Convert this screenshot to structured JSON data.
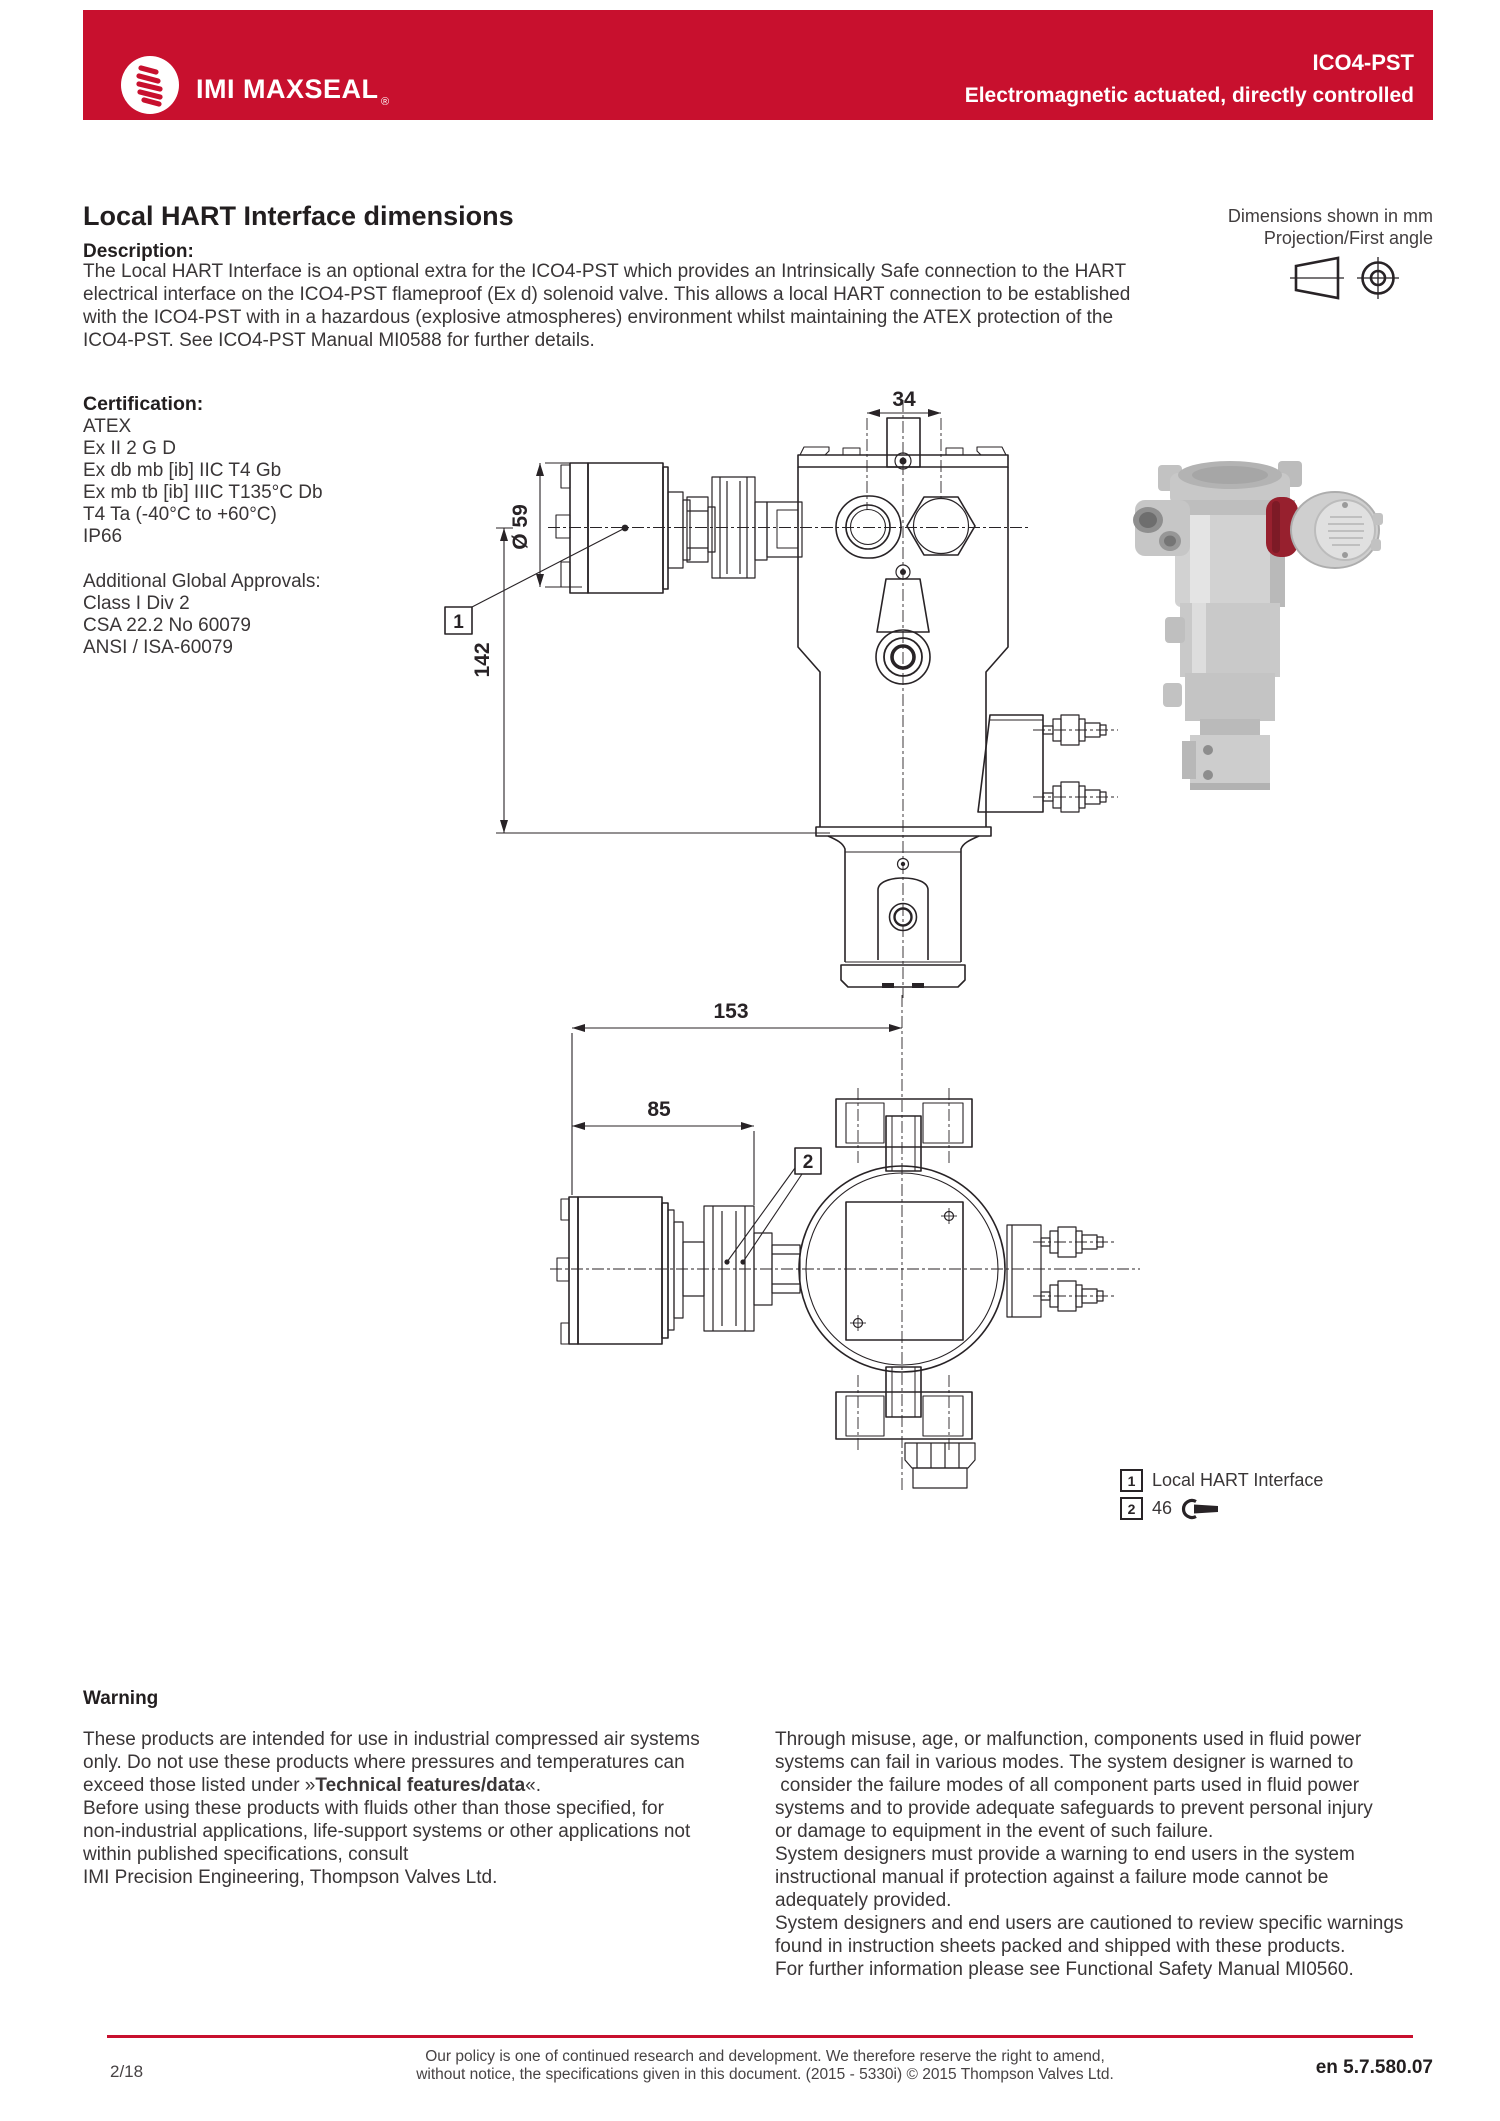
{
  "header": {
    "brand": "IMI MAXSEAL",
    "registered": "®",
    "product": "ICO4-PST",
    "subtitle": "Electromagnetic actuated, directly controlled"
  },
  "colors": {
    "brand_red": "#c8102e",
    "ink": "#282326"
  },
  "intro": {
    "title": "Local HART Interface dimensions",
    "description_label": "Description:",
    "description_lines": [
      "The Local HART Interface is an optional extra for the ICO4-PST which provides an Intrinsically Safe connection to the HART",
      "electrical interface on the ICO4-PST flameproof (Ex d) solenoid valve. This allows a local HART connection to be established",
      "with the ICO4-PST with in a hazardous (explosive atmospheres) environment whilst maintaining the ATEX protection of the",
      "ICO4-PST. See ICO4-PST Manual MI0588 for further details."
    ],
    "dimensions_note": "Dimensions shown in mm",
    "projection_note": "Projection/First angle"
  },
  "certification": {
    "label": "Certification:",
    "lines": [
      "ATEX",
      "Ex II 2 G D",
      "Ex db mb [ib] IIC T4 Gb",
      "Ex mb tb [ib] IIIC T135°C Db",
      "T4 Ta (-40°C to +60°C)",
      "IP66"
    ],
    "approvals_label": "Additional Global Approvals:",
    "approvals": [
      "Class I Div 2",
      "CSA 22.2 No 60079",
      "ANSI / ISA-60079"
    ]
  },
  "drawings": {
    "front_view": {
      "width_dim": "34",
      "diameter_dim": "Ø 59",
      "height_dim": "142",
      "callout": "1"
    },
    "top_view": {
      "overall_dim": "153",
      "interface_dim": "85",
      "callout": "2"
    }
  },
  "legend": {
    "item1_num": "1",
    "item1_label": "Local HART Interface",
    "item2_num": "2",
    "item2_label": "46"
  },
  "warning": {
    "title": "Warning",
    "left_lines": {
      "l1": "These products are intended for use in industrial compressed air systems",
      "l2": "only. Do not use these products where pressures and temperatures can",
      "l3_pre": "exceed those listed under »",
      "l3_bold": "Technical features/data",
      "l3_post": "«.",
      "l4": "Before using these products with fluids other than those specified, for",
      "l5": "non-industrial applications, life-support systems or other applications not",
      "l6": "within published specifications, consult",
      "l7": "IMI Precision Engineering, Thompson Valves Ltd."
    },
    "right_lines": [
      "Through misuse, age, or malfunction, components used in fluid power",
      "systems can fail in various modes. The system designer is warned to",
      " consider the failure modes of all component parts used in fluid power",
      "systems and to provide adequate safeguards to prevent personal injury",
      "or damage to equipment in the event of such failure.",
      "System designers must provide a warning to end users in the system",
      "instructional manual if protection against a failure mode cannot be",
      "adequately provided.",
      "System designers and end users are cautioned to review specific warnings",
      "found in instruction sheets packed and shipped with these products.",
      "For further information please see Functional Safety Manual MI0560."
    ]
  },
  "footer": {
    "page_number": "2/18",
    "policy_line1": "Our policy is one of continued research and development. We therefore reserve the right to amend,",
    "policy_line2": "without notice, the specifications given in this document. (2015 - 5330i) © 2015 Thompson Valves Ltd.",
    "doc_code": "en 5.7.580.07"
  }
}
